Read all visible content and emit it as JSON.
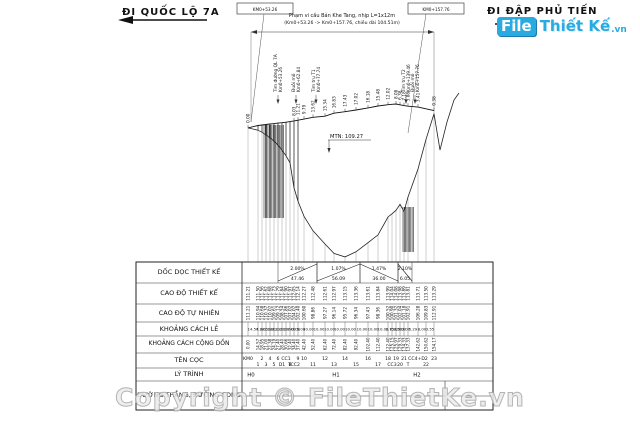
{
  "header": {
    "left_road": "ĐI QUỐC LỘ 7A",
    "right_road": "ĐI ĐẬP PHỦ TIẾN",
    "left_station_box": "KM0+53.26",
    "right_station_box": "KM0+157.76",
    "span_note_line1": "Phạm vi cầu Bản Khe Tang, nhịp L=1x12m",
    "span_note_line2": "(Km0+53.26 -> Km0+157.76, chiều dài 104.51m)"
  },
  "annotations": {
    "water_level": "MTN: 109.27",
    "left_labels": [
      {
        "line1": "Tim đường QL 7A",
        "line2": "Km0+53.26",
        "x": 278
      },
      {
        "line1": "Đuôi mố",
        "line2": "Km0+62.84",
        "x": 296
      },
      {
        "line1": "Tim trụ T1",
        "line2": "Km0+77.74",
        "x": 316
      }
    ],
    "right_labels": [
      {
        "line1": "Tim trụ T2",
        "line2": "Km0+139.46",
        "x": 406
      },
      {
        "line1": "Đuôi mố",
        "line2": "Km0+157.76",
        "x": 415
      }
    ]
  },
  "table": {
    "row_labels": [
      "DỐC DỌC THIẾT KẾ",
      "CAO ĐỘ THIẾT KẾ",
      "CAO ĐỘ  TỰ NHIÊN",
      "KHOẢNG CÁCH LẺ",
      "KHOẢNG CÁCH CỘNG DỒN",
      "TÊN CỌC",
      "LÝ TRÌNH",
      "ĐƯỜNG THẲNG, ĐƯỜNG CONG"
    ],
    "km_marks": [
      {
        "label": "H0",
        "x": 251
      },
      {
        "label": "H1",
        "x": 336
      },
      {
        "label": "H2",
        "x": 417
      }
    ]
  },
  "chart_data": {
    "type": "table",
    "title": "Trắc dọc cầu Bản Khe Tang",
    "stakes": {
      "names": [
        "KM0",
        "1",
        "2",
        "3",
        "4",
        "5",
        "6",
        "D1",
        "CC1",
        "8",
        "TCC2",
        "9",
        "10",
        "11",
        "12",
        "13",
        "14",
        "15",
        "16",
        "17",
        "18",
        "CC3",
        "19",
        "20",
        "21",
        "T",
        "CC4+D2",
        "22",
        "23"
      ],
      "name_row": [
        "t",
        "b",
        "t",
        "b",
        "t",
        "b",
        "t",
        "b",
        "t",
        "b",
        "b",
        "t",
        "t",
        "b",
        "t",
        "b",
        "t",
        "b",
        "t",
        "b",
        "t",
        "b",
        "t",
        "b",
        "t",
        "b",
        "t",
        "b",
        "t"
      ],
      "x": [
        248,
        258,
        262,
        266,
        270,
        274,
        278,
        282,
        286,
        290,
        294,
        298,
        304,
        313,
        325,
        334,
        345,
        356,
        368,
        378,
        388,
        392,
        396,
        400,
        404,
        408,
        418,
        426,
        434
      ],
      "design_elev": [
        "111.21",
        "111.50",
        "111.56",
        "111.62",
        "111.68",
        "111.73",
        "111.79",
        "111.84",
        "111.90",
        "111.97",
        "112.05",
        "112.14",
        "112.27",
        "112.48",
        "112.61",
        "112.97",
        "113.15",
        "113.36",
        "113.61",
        "113.84",
        "113.99",
        "114.04",
        "114.08",
        "113.98",
        "113.89",
        "113.81",
        "113.71",
        "113.50",
        "113.29"
      ],
      "natural_elev": [
        "111.21",
        "110.94",
        "110.68",
        "110.37",
        "110.02",
        "109.61",
        "109.12",
        "108.54",
        "107.86",
        "107.02",
        "104.02",
        "102.40",
        "100.60",
        "98.86",
        "97.27",
        "96.14",
        "95.72",
        "96.34",
        "97.43",
        "98.36",
        "100.52",
        "100.90",
        "101.32",
        "102.04",
        "101.18",
        "102.91",
        "106.28",
        "109.83",
        "112.91"
      ],
      "heights": [
        "0.00",
        "",
        "",
        "",
        "",
        "",
        "",
        "",
        "",
        "",
        "8.03",
        "11.21",
        "9.79",
        "13.62",
        "15.34",
        "16.83",
        "17.43",
        "17.02",
        "16.18",
        "15.48",
        "12.02",
        "",
        "8.08",
        "6.38",
        "7.18",
        "5.88",
        "3.41",
        "",
        "0.38"
      ],
      "dist": [
        "14.57",
        "4.38",
        "2.05",
        "1.38",
        "1.81",
        "3.21",
        "1.00",
        "2.26",
        "1.74",
        "2.00",
        "3.00",
        "5.00",
        "10.00",
        "10.00",
        "10.00",
        "10.00",
        "10.00",
        "10.00",
        "10.00",
        "10.00",
        "2.75",
        "0.82",
        "3.36",
        "5.00",
        "3.00",
        "5.29",
        "8.00",
        "3.55"
      ],
      "cum_dist": [
        "0.00",
        "14.57",
        "18.95",
        "21.00",
        "22.38",
        "24.19",
        "27.40",
        "28.40",
        "30.66",
        "32.40",
        "34.40",
        "37.40",
        "42.40",
        "52.40",
        "62.40",
        "72.40",
        "82.40",
        "92.40",
        "102.40",
        "112.40",
        "122.40",
        "125.15",
        "125.97",
        "129.33",
        "134.33",
        "137.33",
        "142.62",
        "150.62",
        "154.17"
      ]
    },
    "slopes": [
      {
        "grade": "2.00%",
        "length": "47.46",
        "dir": "up",
        "x1": 278,
        "x2": 317
      },
      {
        "grade": "1.07%",
        "length": "56.09",
        "dir": "up",
        "x1": 317,
        "x2": 360
      },
      {
        "grade": "1.47%",
        "length": "36.00",
        "dir": "down",
        "x1": 360,
        "x2": 398
      },
      {
        "grade": "2.10%",
        "length": "6.05",
        "dir": "down",
        "x1": 398,
        "x2": 412
      }
    ]
  },
  "geometry": {
    "elev_ref": 114.08,
    "y_top": 104,
    "px_per_m": 8.33,
    "table": {
      "x1": 136,
      "x2": 493,
      "col": 242,
      "rows_y": [
        262,
        283,
        304,
        322,
        336,
        353,
        368,
        381,
        410
      ],
      "tick_x": 445,
      "mid_y": 396
    },
    "ground_extra": [
      [
        440,
        150
      ],
      [
        447,
        122
      ],
      [
        454,
        100
      ],
      [
        459,
        93
      ]
    ],
    "left_hatch": {
      "x1": 264,
      "x2": 284,
      "y1": 125,
      "y2": 218
    },
    "right_hatch": {
      "x1": 403,
      "x2": 414,
      "y1": 207,
      "y2": 252
    },
    "dimension": {
      "y": 32,
      "x1": 251,
      "x2": 434
    },
    "leaders": [
      [
        264,
        14,
        251,
        122
      ],
      [
        426,
        14,
        408,
        133
      ]
    ],
    "boxes": [
      {
        "x": 237,
        "y": 3,
        "w": 56,
        "h": 11
      },
      {
        "x": 408,
        "y": 3,
        "w": 56,
        "h": 11
      }
    ]
  },
  "watermark": {
    "logo_file": "File",
    "logo_thiet_ke": "Thiết Kế",
    "logo_vn": ".vn",
    "copyright": "Copyright © FileThietKe.vn",
    "accent": "#29abe2"
  }
}
